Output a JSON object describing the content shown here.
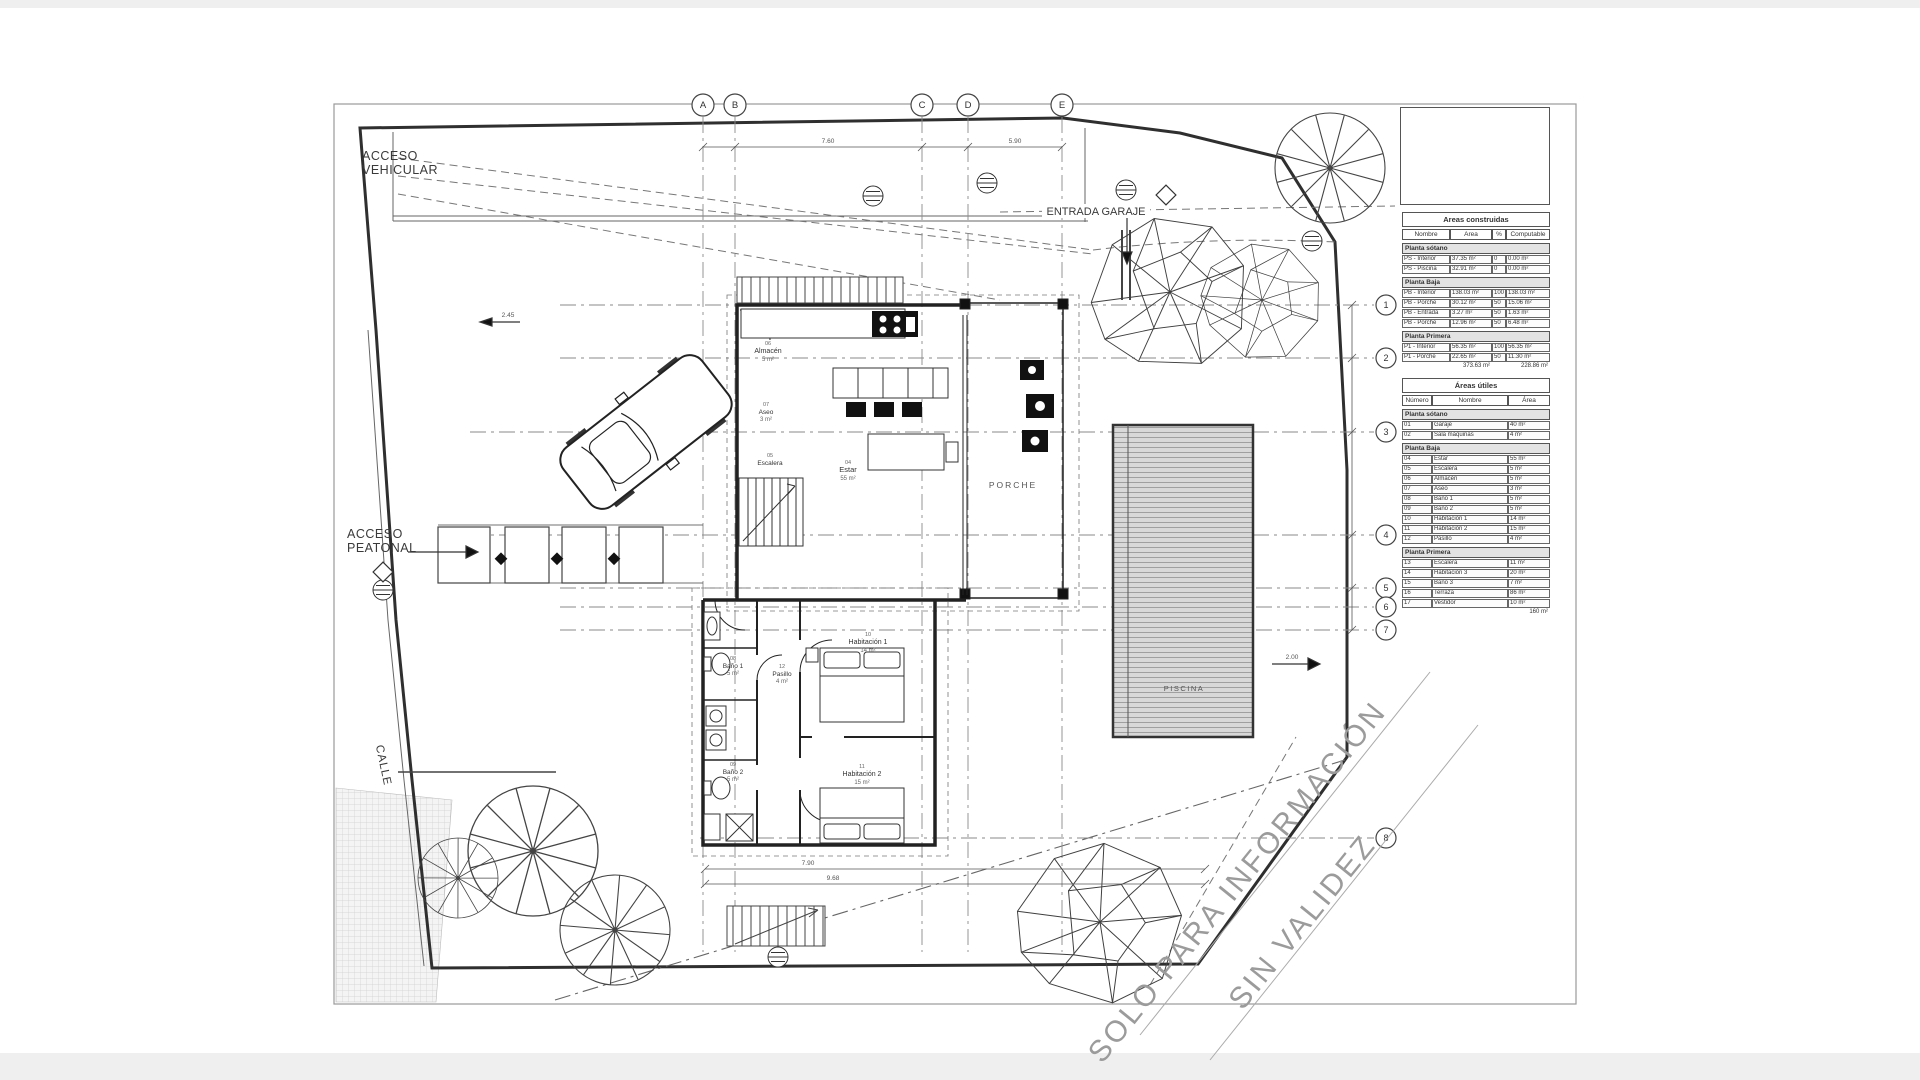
{
  "page": {
    "background": "#ffffff",
    "scan_edge_color": "#efefef"
  },
  "colors": {
    "ink": "#3a3a3a",
    "wall": "#222222",
    "dash": "#777777",
    "pool_fill": "#d8d8d8",
    "watermark": "#9b9b9b"
  },
  "grid": {
    "letters": [
      "A",
      "B",
      "C",
      "D",
      "E"
    ],
    "numbers": [
      "1",
      "2",
      "3",
      "4",
      "5",
      "6",
      "7",
      "8"
    ]
  },
  "site": {
    "acceso_vehicular": [
      "ACCESO",
      "VEHICULAR"
    ],
    "acceso_peatonal": [
      "ACCESO",
      "PEATONAL"
    ],
    "entrada_garaje": "ENTRADA GARAJE",
    "calle": "CALLE"
  },
  "rooms": {
    "porche": {
      "name": "PORCHE"
    },
    "piscina": {
      "name": "PISCINA"
    },
    "estar": {
      "num": "04",
      "name": "Estar",
      "area": "55 m²"
    },
    "escalera": {
      "num": "05",
      "name": "Escalera",
      "area": "5 m²"
    },
    "almacen": {
      "num": "06",
      "name": "Almacén",
      "area": "5 m²"
    },
    "aseo": {
      "num": "07",
      "name": "Aseo",
      "area": "3 m²"
    },
    "bano1": {
      "num": "08",
      "name": "Baño 1",
      "area": "5 m²"
    },
    "bano2": {
      "num": "09",
      "name": "Baño 2",
      "area": "5 m²"
    },
    "hab1": {
      "num": "10",
      "name": "Habitación 1",
      "area": "14 m²"
    },
    "hab2": {
      "num": "11",
      "name": "Habitación 2",
      "area": "15 m²"
    },
    "pasillo": {
      "num": "12",
      "name": "Pasillo",
      "area": "4 m²"
    }
  },
  "dimensions": {
    "top_left": "7.60",
    "top_right": "5.90",
    "bottom_1": "7.90",
    "bottom_2": "9.68",
    "pool": "2.00",
    "left": "2.45"
  },
  "watermark": {
    "line1": "SOLO PARA INFORMACIÓN",
    "line2": "SIN VALIDEZ"
  },
  "tables": {
    "construidas": {
      "title": "Areas construidas",
      "columns": [
        "Nombre",
        "Area",
        "%",
        "Computable"
      ],
      "groups": [
        {
          "label": "Planta sótano",
          "rows": [
            [
              "PS - Interior",
              "37.35 m²",
              "0",
              "0.00 m²"
            ],
            [
              "PS - Piscina",
              "32.91 m²",
              "0",
              "0.00 m²"
            ]
          ]
        },
        {
          "label": "Planta Baja",
          "rows": [
            [
              "PB - Interior",
              "138.03 m²",
              "100",
              "138.03 m²"
            ],
            [
              "PB - Porche",
              "30.12 m²",
              "50",
              "15.06 m²"
            ],
            [
              "PB - Entrada",
              "3.27 m²",
              "50",
              "1.63 m²"
            ],
            [
              "PB - Porche",
              "12.96 m²",
              "50",
              "6.48 m²"
            ]
          ]
        },
        {
          "label": "Planta Primera",
          "rows": [
            [
              "P1 - Interior",
              "56.35 m²",
              "100",
              "56.35 m²"
            ],
            [
              "P1 - Porche",
              "22.65 m²",
              "50",
              "11.30 m²"
            ]
          ]
        }
      ],
      "total_area": "373.63 m²",
      "total_computable": "228.86 m²"
    },
    "utiles": {
      "title": "Áreas útiles",
      "columns": [
        "Número",
        "Nombre",
        "Área"
      ],
      "groups": [
        {
          "label": "Planta sótano",
          "rows": [
            [
              "01",
              "Garaje",
              "40 m²"
            ],
            [
              "02",
              "Sala máquinas",
              "4 m²"
            ]
          ]
        },
        {
          "label": "Planta Baja",
          "rows": [
            [
              "04",
              "Estar",
              "55 m²"
            ],
            [
              "05",
              "Escalera",
              "5 m²"
            ],
            [
              "06",
              "Almacén",
              "5 m²"
            ],
            [
              "07",
              "Aseo",
              "3 m²"
            ],
            [
              "08",
              "Baño 1",
              "5 m²"
            ],
            [
              "09",
              "Baño 2",
              "5 m²"
            ],
            [
              "10",
              "Habitación 1",
              "14 m²"
            ],
            [
              "11",
              "Habitación 2",
              "15 m²"
            ],
            [
              "12",
              "Pasillo",
              "4 m²"
            ]
          ]
        },
        {
          "label": "Planta Primera",
          "rows": [
            [
              "13",
              "Escalera",
              "11 m²"
            ],
            [
              "14",
              "Habitación 3",
              "20 m²"
            ],
            [
              "15",
              "Baño 3",
              "7 m²"
            ],
            [
              "16",
              "Terraza",
              "86 m²"
            ],
            [
              "17",
              "Vestidor",
              "10 m²"
            ]
          ]
        }
      ],
      "total": "160 m²"
    }
  }
}
